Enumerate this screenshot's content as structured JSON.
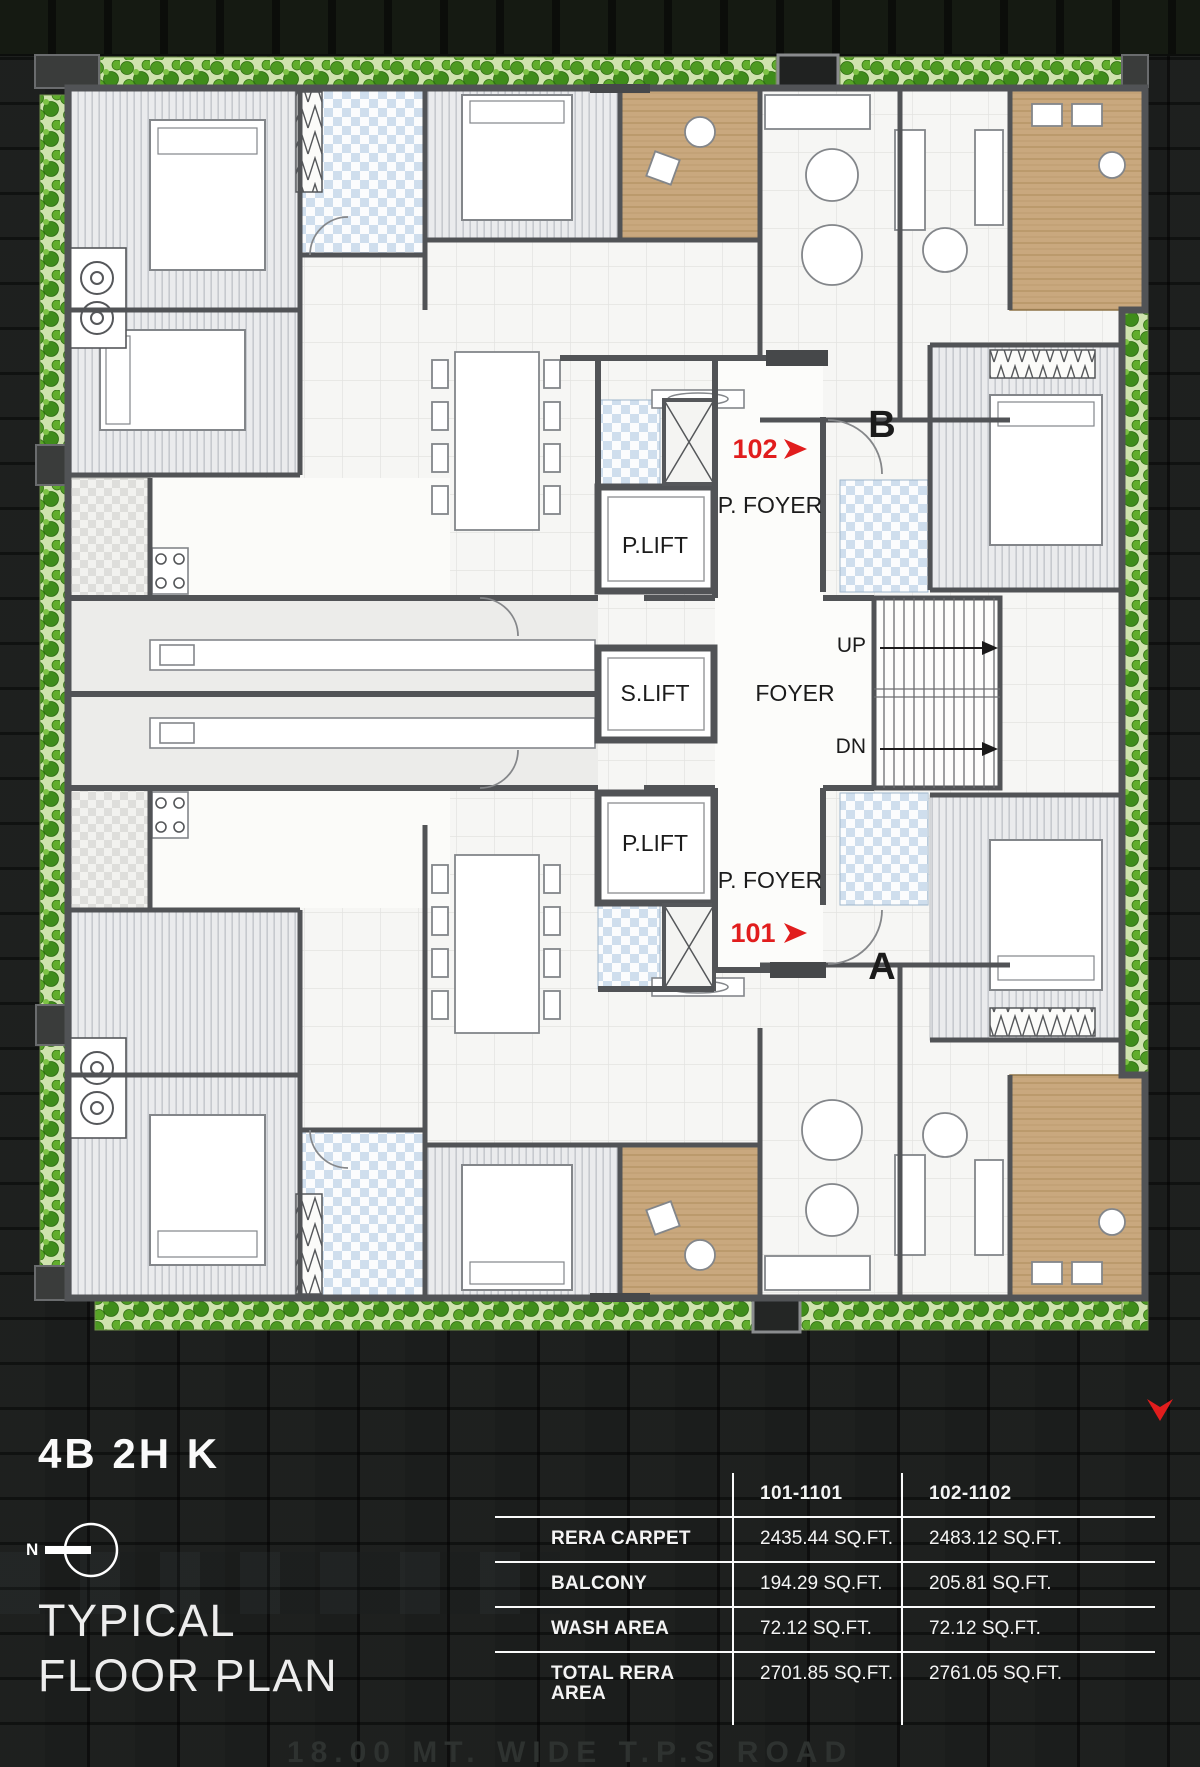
{
  "plan": {
    "title": "4B 2H K",
    "subtitle_line1": "TYPICAL",
    "subtitle_line2": "FLOOR PLAN",
    "north_label": "N",
    "road_label": "18.00 MT. WIDE T.P.S ROAD",
    "labels": {
      "p_lift_top": "P.LIFT",
      "p_foyer_top": "P. FOYER",
      "s_lift": "S.LIFT",
      "foyer": "FOYER",
      "up": "UP",
      "dn": "DN",
      "p_lift_bottom": "P.LIFT",
      "p_foyer_bottom": "P. FOYER",
      "unit_top_number": "102",
      "unit_top_letter": "B",
      "unit_bottom_number": "101",
      "unit_bottom_letter": "A"
    },
    "colors": {
      "accent_red": "#e11d1d",
      "hedge_green": "#4d9a22",
      "balcony_tan": "#c9a87e",
      "bath_blue": "#cfdeed",
      "wall_gray": "#515356"
    }
  },
  "area_table": {
    "columns": [
      "101-1101",
      "102-1102"
    ],
    "rows": [
      {
        "label": "RERA CARPET",
        "values": [
          "2435.44 SQ.FT.",
          "2483.12 SQ.FT."
        ]
      },
      {
        "label": "BALCONY",
        "values": [
          "194.29 SQ.FT.",
          "205.81 SQ.FT."
        ]
      },
      {
        "label": "WASH AREA",
        "values": [
          "72.12 SQ.FT.",
          "72.12 SQ.FT."
        ]
      },
      {
        "label": "TOTAL RERA AREA",
        "values": [
          "2701.85 SQ.FT.",
          "2761.05 SQ.FT."
        ]
      }
    ]
  }
}
